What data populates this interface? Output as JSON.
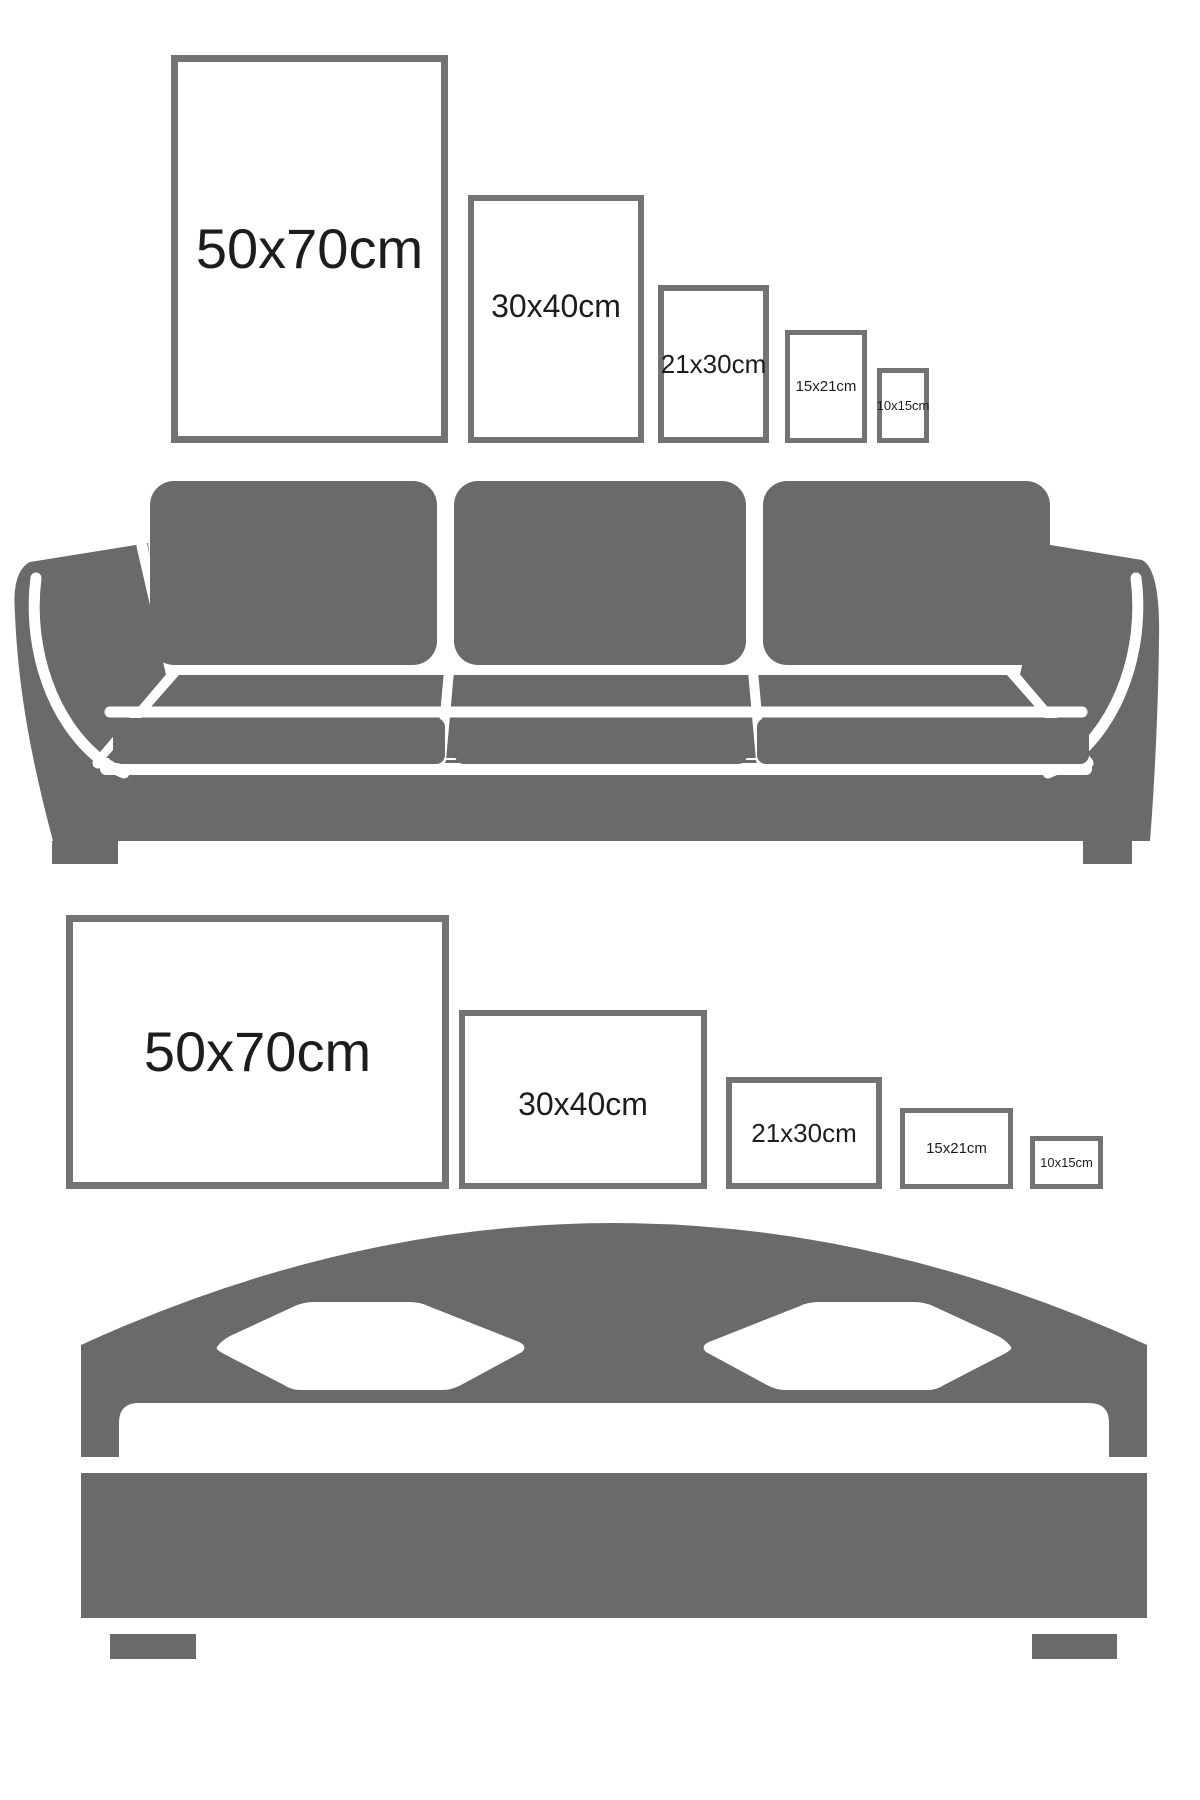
{
  "colors": {
    "background": "#ffffff",
    "furniture": "#6a6a6a",
    "frame-border": "#717375",
    "label": "#1d1d1d"
  },
  "top_section": {
    "furniture": "sofa",
    "frames": [
      {
        "size_label": "50x70cm",
        "orientation": "portrait"
      },
      {
        "size_label": "30x40cm",
        "orientation": "portrait"
      },
      {
        "size_label": "21x30cm",
        "orientation": "portrait"
      },
      {
        "size_label": "15x21cm",
        "orientation": "portrait"
      },
      {
        "size_label": "10x15cm",
        "orientation": "portrait"
      }
    ]
  },
  "bottom_section": {
    "furniture": "double bed",
    "frames": [
      {
        "size_label": "50x70cm",
        "orientation": "landscape"
      },
      {
        "size_label": "30x40cm",
        "orientation": "landscape"
      },
      {
        "size_label": "21x30cm",
        "orientation": "landscape"
      },
      {
        "size_label": "15x21cm",
        "orientation": "landscape"
      },
      {
        "size_label": "10x15cm",
        "orientation": "landscape"
      }
    ]
  }
}
